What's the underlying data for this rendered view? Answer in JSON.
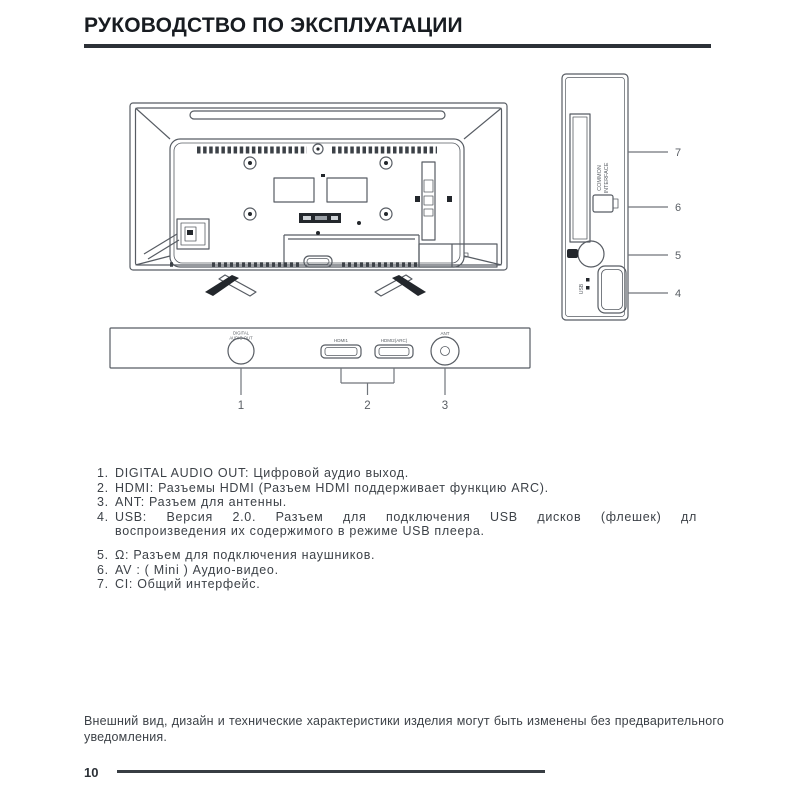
{
  "page": {
    "title": "РУКОВОДСТВО ПО ЭКСПЛУАТАЦИИ",
    "page_number": "10",
    "footer_note": "Внешний вид, дизайн и технические характеристики изделия могут быть изменены без предварительного уведомления."
  },
  "diagram": {
    "side_panel": {
      "ci_label_line1": "COMMON",
      "ci_label_line2": "INTERFACE",
      "usb_label": "USB",
      "callout_7": "7",
      "callout_6": "6",
      "callout_5": "5",
      "callout_4": "4"
    },
    "bottom_panel": {
      "audio_out_label_line1": "DIGITAL",
      "audio_out_label_line2": "AUDIO OUT",
      "hdmi1_label": "HDMI1",
      "hdmi2_label": "HDMI2(ARC)",
      "ant_label": "ANT",
      "callout_1": "1",
      "callout_2": "2",
      "callout_3": "3"
    }
  },
  "connector_list": {
    "items": [
      {
        "num": "1.",
        "text": "DIGITAL AUDIO OUT: Цифровой аудио выход."
      },
      {
        "num": "2.",
        "text": "HDMI: Разъемы HDMI (Разъем HDMI поддерживает функцию ARC)."
      },
      {
        "num": "3.",
        "text": "ANT: Разъем для антенны."
      },
      {
        "num": "4.",
        "text_line1": "USB: Версия 2.0. Разъем для подключения USB дисков (флешек) дл",
        "text_line2": "воспроизведения их содержимого в режиме USB плеера."
      },
      {
        "num": "5.",
        "text": "Ω: Разъем для подключения наушников."
      },
      {
        "num": "6.",
        "text": "AV : ( Mini ) Аудио-видео."
      },
      {
        "num": "7.",
        "text": "CI: Общий интерфейс."
      }
    ]
  }
}
